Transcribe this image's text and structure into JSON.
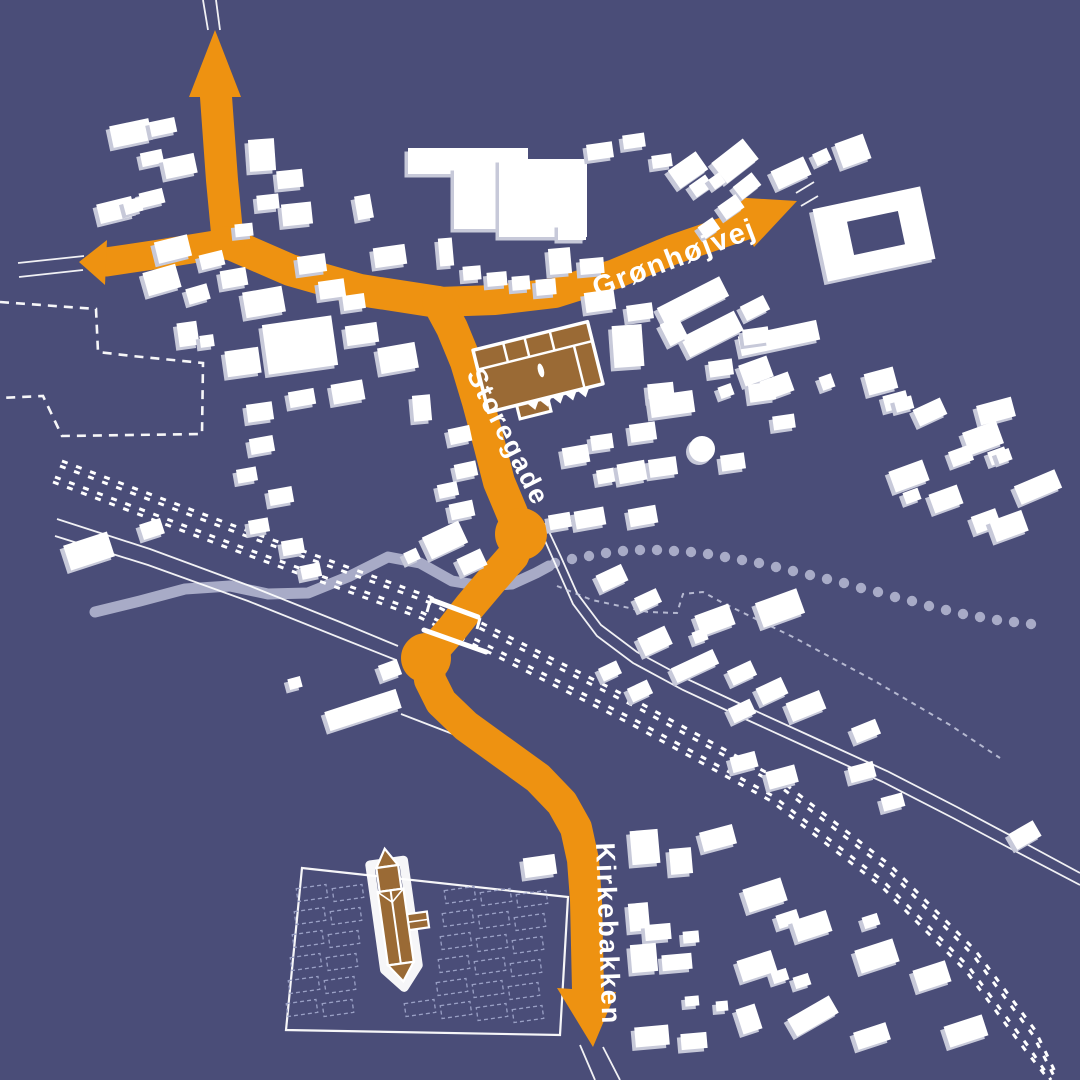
{
  "map": {
    "labels": {
      "storegade": "Storegade",
      "gronhojvej": "Grønhøjvej",
      "kirkebakken": "Kirkebakken"
    },
    "colors": {
      "bg": "#4a4d78",
      "road": "#ee9211",
      "btop": "#ffffff",
      "bside": "#c7c9d9",
      "brown": "#9a6a35",
      "water": "#a8abc7",
      "line": "#ffffff",
      "plot": "#9aa0c5",
      "dash": "#c9cce0"
    },
    "features": {
      "highlighted_building": "factory-building-brown",
      "church": "church-brown",
      "cemetery": "churchyard-with-plots",
      "railway": "double-track-dashed",
      "stream": "solid-then-dotted"
    },
    "buildings": [
      [
        131,
        133,
        40,
        22,
        -12
      ],
      [
        163,
        127,
        26,
        15,
        -12
      ],
      [
        152,
        158,
        22,
        14,
        -12
      ],
      [
        180,
        166,
        32,
        20,
        -12
      ],
      [
        116,
        210,
        36,
        20,
        -14
      ],
      [
        152,
        198,
        24,
        15,
        -14
      ],
      [
        133,
        206,
        18,
        14,
        -15
      ],
      [
        262,
        155,
        26,
        32,
        -4
      ],
      [
        290,
        179,
        26,
        18,
        -6
      ],
      [
        268,
        202,
        22,
        15,
        -6
      ],
      [
        297,
        214,
        30,
        22,
        -6
      ],
      [
        244,
        230,
        18,
        13,
        -6
      ],
      [
        173,
        249,
        34,
        22,
        -14
      ],
      [
        212,
        260,
        24,
        15,
        -14
      ],
      [
        162,
        280,
        34,
        24,
        -16
      ],
      [
        198,
        294,
        22,
        16,
        -16
      ],
      [
        234,
        278,
        26,
        18,
        -10
      ],
      [
        264,
        302,
        40,
        26,
        -10
      ],
      [
        312,
        264,
        28,
        18,
        -8
      ],
      [
        332,
        289,
        26,
        18,
        -8
      ],
      [
        354,
        302,
        22,
        15,
        -8
      ],
      [
        188,
        334,
        20,
        24,
        -8
      ],
      [
        207,
        341,
        14,
        12,
        -8
      ],
      [
        243,
        362,
        34,
        26,
        -8
      ],
      [
        300,
        345,
        70,
        50,
        -8
      ],
      [
        362,
        334,
        32,
        20,
        -8
      ],
      [
        398,
        358,
        38,
        26,
        -10
      ],
      [
        348,
        392,
        32,
        20,
        -10
      ],
      [
        302,
        398,
        26,
        16,
        -10
      ],
      [
        422,
        408,
        18,
        26,
        -5
      ],
      [
        260,
        412,
        26,
        18,
        -8
      ],
      [
        468,
        161,
        120,
        26,
        0
      ],
      [
        483,
        198,
        58,
        62,
        0
      ],
      [
        543,
        198,
        88,
        78,
        0
      ],
      [
        572,
        232,
        28,
        16,
        0
      ],
      [
        364,
        207,
        16,
        24,
        -10
      ],
      [
        390,
        256,
        32,
        20,
        -8
      ],
      [
        446,
        252,
        14,
        28,
        -5
      ],
      [
        472,
        273,
        18,
        14,
        -5
      ],
      [
        497,
        279,
        20,
        14,
        -5
      ],
      [
        521,
        283,
        18,
        14,
        -5
      ],
      [
        546,
        287,
        20,
        16,
        -5
      ],
      [
        560,
        261,
        22,
        26,
        -5
      ],
      [
        592,
        266,
        24,
        16,
        -5
      ],
      [
        600,
        151,
        26,
        16,
        -8
      ],
      [
        634,
        141,
        22,
        14,
        -8
      ],
      [
        662,
        161,
        20,
        13,
        -8
      ],
      [
        688,
        170,
        34,
        22,
        -35
      ],
      [
        701,
        186,
        20,
        14,
        -35
      ],
      [
        735,
        161,
        40,
        26,
        -38
      ],
      [
        747,
        186,
        24,
        16,
        -38
      ],
      [
        791,
        173,
        36,
        20,
        -25
      ],
      [
        822,
        157,
        16,
        13,
        -25
      ],
      [
        853,
        151,
        30,
        26,
        -20
      ],
      [
        717,
        181,
        13,
        12,
        -35
      ],
      [
        731,
        207,
        22,
        16,
        -35
      ],
      [
        709,
        228,
        18,
        14,
        -35
      ],
      [
        874,
        234,
        110,
        74,
        -12
      ],
      [
        693,
        302,
        70,
        22,
        -27
      ],
      [
        755,
        308,
        26,
        16,
        -27
      ],
      [
        712,
        334,
        60,
        22,
        -27
      ],
      [
        674,
        331,
        20,
        24,
        -27
      ],
      [
        779,
        338,
        80,
        20,
        -12
      ],
      [
        756,
        371,
        30,
        22,
        -20
      ],
      [
        777,
        386,
        30,
        20,
        -20
      ],
      [
        726,
        391,
        14,
        12,
        -20
      ],
      [
        827,
        382,
        13,
        14,
        -20
      ],
      [
        881,
        381,
        30,
        22,
        -15
      ],
      [
        896,
        401,
        24,
        16,
        -15
      ],
      [
        904,
        404,
        18,
        13,
        -15
      ],
      [
        930,
        412,
        30,
        18,
        -25
      ],
      [
        996,
        411,
        36,
        20,
        -15
      ],
      [
        983,
        438,
        36,
        24,
        -20
      ],
      [
        998,
        456,
        18,
        14,
        -20
      ],
      [
        961,
        456,
        22,
        16,
        -20
      ],
      [
        1004,
        456,
        14,
        12,
        -20
      ],
      [
        909,
        476,
        36,
        22,
        -20
      ],
      [
        912,
        496,
        16,
        12,
        -20
      ],
      [
        946,
        499,
        30,
        20,
        -20
      ],
      [
        1038,
        487,
        44,
        20,
        -23
      ],
      [
        986,
        521,
        26,
        18,
        -20
      ],
      [
        1009,
        526,
        34,
        22,
        -20
      ],
      [
        600,
        301,
        30,
        20,
        -8
      ],
      [
        640,
        312,
        26,
        16,
        -8
      ],
      [
        628,
        346,
        30,
        42,
        -4
      ],
      [
        661,
        392,
        26,
        18,
        -6
      ],
      [
        672,
        404,
        44,
        22,
        -8
      ],
      [
        643,
        432,
        26,
        18,
        -8
      ],
      [
        602,
        442,
        22,
        15,
        -8
      ],
      [
        663,
        467,
        28,
        18,
        -8
      ],
      [
        733,
        462,
        24,
        16,
        -8
      ],
      [
        762,
        392,
        26,
        18,
        -8
      ],
      [
        784,
        422,
        22,
        14,
        -8
      ],
      [
        721,
        368,
        24,
        16,
        -8
      ],
      [
        756,
        336,
        26,
        16,
        -8
      ],
      [
        460,
        435,
        22,
        16,
        -12
      ],
      [
        466,
        470,
        22,
        15,
        -12
      ],
      [
        448,
        490,
        20,
        14,
        -12
      ],
      [
        462,
        510,
        24,
        16,
        -12
      ],
      [
        576,
        455,
        26,
        18,
        -10
      ],
      [
        606,
        476,
        18,
        14,
        -10
      ],
      [
        632,
        472,
        28,
        20,
        -10
      ],
      [
        590,
        518,
        30,
        18,
        -10
      ],
      [
        643,
        516,
        28,
        18,
        -10
      ],
      [
        560,
        521,
        22,
        15,
        -10
      ],
      [
        262,
        445,
        24,
        16,
        -10
      ],
      [
        247,
        475,
        20,
        14,
        -10
      ],
      [
        281,
        496,
        24,
        16,
        -10
      ],
      [
        259,
        526,
        20,
        14,
        -10
      ],
      [
        293,
        547,
        22,
        15,
        -10
      ],
      [
        311,
        571,
        20,
        14,
        -12
      ],
      [
        89,
        551,
        46,
        26,
        -18
      ],
      [
        152,
        529,
        22,
        16,
        -18
      ],
      [
        445,
        540,
        40,
        24,
        -25
      ],
      [
        472,
        562,
        26,
        18,
        -25
      ],
      [
        412,
        556,
        14,
        12,
        -25
      ],
      [
        612,
        578,
        28,
        18,
        -25
      ],
      [
        648,
        600,
        24,
        15,
        -25
      ],
      [
        780,
        608,
        44,
        26,
        -20
      ],
      [
        715,
        620,
        36,
        22,
        -20
      ],
      [
        700,
        636,
        14,
        12,
        -20
      ],
      [
        655,
        641,
        30,
        20,
        -25
      ],
      [
        695,
        666,
        46,
        16,
        -25
      ],
      [
        742,
        673,
        26,
        16,
        -25
      ],
      [
        610,
        671,
        20,
        14,
        -25
      ],
      [
        640,
        691,
        22,
        15,
        -25
      ],
      [
        772,
        691,
        28,
        18,
        -25
      ],
      [
        806,
        706,
        36,
        20,
        -22
      ],
      [
        742,
        711,
        24,
        16,
        -25
      ],
      [
        866,
        731,
        26,
        16,
        -22
      ],
      [
        718,
        838,
        34,
        20,
        -15
      ],
      [
        744,
        762,
        26,
        16,
        -15
      ],
      [
        782,
        777,
        30,
        18,
        -15
      ],
      [
        862,
        772,
        26,
        16,
        -15
      ],
      [
        893,
        802,
        22,
        14,
        -15
      ],
      [
        765,
        895,
        40,
        24,
        -18
      ],
      [
        788,
        919,
        22,
        14,
        -18
      ],
      [
        812,
        926,
        36,
        22,
        -18
      ],
      [
        871,
        921,
        16,
        12,
        -18
      ],
      [
        757,
        966,
        36,
        22,
        -18
      ],
      [
        780,
        976,
        16,
        12,
        -18
      ],
      [
        802,
        981,
        16,
        12,
        -18
      ],
      [
        877,
        956,
        40,
        24,
        -18
      ],
      [
        932,
        976,
        34,
        22,
        -18
      ],
      [
        749,
        1019,
        20,
        26,
        -18
      ],
      [
        813,
        1016,
        48,
        20,
        -30
      ],
      [
        872,
        1036,
        34,
        18,
        -18
      ],
      [
        966,
        1031,
        40,
        22,
        -18
      ],
      [
        1025,
        835,
        28,
        18,
        -30
      ],
      [
        645,
        847,
        28,
        34,
        -5
      ],
      [
        681,
        861,
        22,
        26,
        -5
      ],
      [
        639,
        917,
        20,
        28,
        -5
      ],
      [
        658,
        932,
        26,
        16,
        -5
      ],
      [
        691,
        937,
        16,
        12,
        -5
      ],
      [
        644,
        958,
        26,
        28,
        -5
      ],
      [
        677,
        962,
        30,
        16,
        -5
      ],
      [
        692,
        1001,
        14,
        10,
        -5
      ],
      [
        722,
        1006,
        12,
        10,
        -5
      ],
      [
        652,
        1036,
        34,
        20,
        -5
      ],
      [
        694,
        1041,
        26,
        16,
        -5
      ],
      [
        540,
        866,
        32,
        20,
        -8
      ],
      [
        295,
        683,
        13,
        11,
        -15
      ],
      [
        390,
        670,
        20,
        16,
        -20
      ],
      [
        363,
        710,
        75,
        20,
        -18
      ]
    ],
    "round_buildings": [
      [
        702,
        449,
        13
      ]
    ],
    "courtyard_holes": [
      [
        876,
        233,
        52,
        34,
        -12
      ]
    ],
    "cemetery_plots": [
      [
        312,
        893
      ],
      [
        348,
        893
      ],
      [
        460,
        895
      ],
      [
        496,
        897
      ],
      [
        532,
        899
      ],
      [
        310,
        916
      ],
      [
        346,
        916
      ],
      [
        458,
        918
      ],
      [
        494,
        920
      ],
      [
        530,
        922
      ],
      [
        308,
        939
      ],
      [
        344,
        939
      ],
      [
        456,
        941
      ],
      [
        492,
        943
      ],
      [
        528,
        945
      ],
      [
        306,
        962
      ],
      [
        342,
        962
      ],
      [
        454,
        964
      ],
      [
        490,
        966
      ],
      [
        526,
        968
      ],
      [
        304,
        985
      ],
      [
        340,
        985
      ],
      [
        452,
        987
      ],
      [
        488,
        989
      ],
      [
        524,
        991
      ],
      [
        302,
        1008
      ],
      [
        338,
        1008
      ],
      [
        420,
        1008
      ],
      [
        456,
        1010
      ],
      [
        492,
        1012
      ],
      [
        528,
        1014
      ]
    ],
    "stream_dots": [
      [
        555,
        563
      ],
      [
        572,
        559
      ],
      [
        589,
        556
      ],
      [
        606,
        553
      ],
      [
        623,
        551
      ],
      [
        640,
        550
      ],
      [
        657,
        550
      ],
      [
        674,
        551
      ],
      [
        691,
        552
      ],
      [
        708,
        554
      ],
      [
        725,
        557
      ],
      [
        742,
        560
      ],
      [
        759,
        563
      ],
      [
        776,
        567
      ],
      [
        793,
        571
      ],
      [
        810,
        575
      ],
      [
        827,
        579
      ],
      [
        844,
        583
      ],
      [
        861,
        588
      ],
      [
        878,
        592
      ],
      [
        895,
        597
      ],
      [
        912,
        601
      ],
      [
        929,
        606
      ],
      [
        946,
        610
      ],
      [
        963,
        614
      ],
      [
        980,
        617
      ],
      [
        997,
        620
      ],
      [
        1014,
        622
      ],
      [
        1031,
        624
      ]
    ]
  }
}
